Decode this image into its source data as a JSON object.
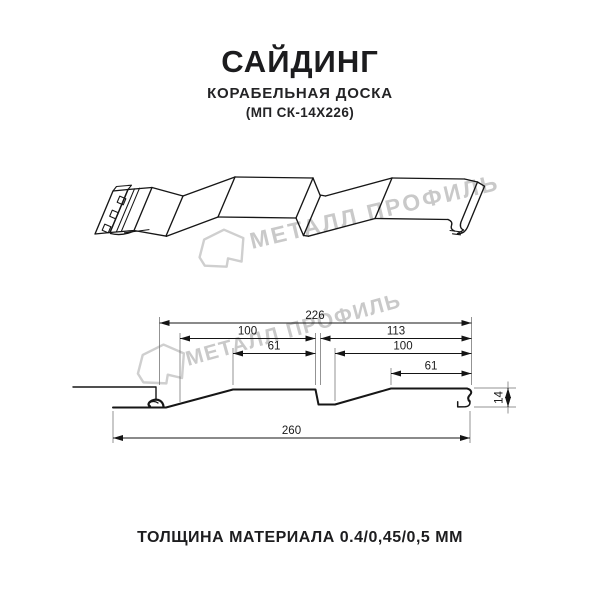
{
  "header": {
    "title": "САЙДИНГ",
    "subtitle": "КОРАБЕЛЬНАЯ ДОСКА",
    "model": "(МП СК-14Х226)"
  },
  "watermark": {
    "brand": "МЕТАЛЛ ПРОФИЛЬ",
    "color": "#c9c9c9"
  },
  "section_dims": {
    "overall_width_top": "226",
    "left_board_width": "100",
    "right_board_width": "113",
    "left_flat_width": "61",
    "right_inner_width": "100",
    "right_flat_width": "61",
    "profile_height": "14",
    "overall_width_bottom": "260"
  },
  "footer": {
    "thickness_note": "ТОЛЩИНА МАТЕРИАЛА 0.4/0,45/0,5 ММ"
  },
  "drawing_colors": {
    "line": "#161616",
    "dimension_line": "#151515",
    "extension_line": "#6f6f6f"
  }
}
